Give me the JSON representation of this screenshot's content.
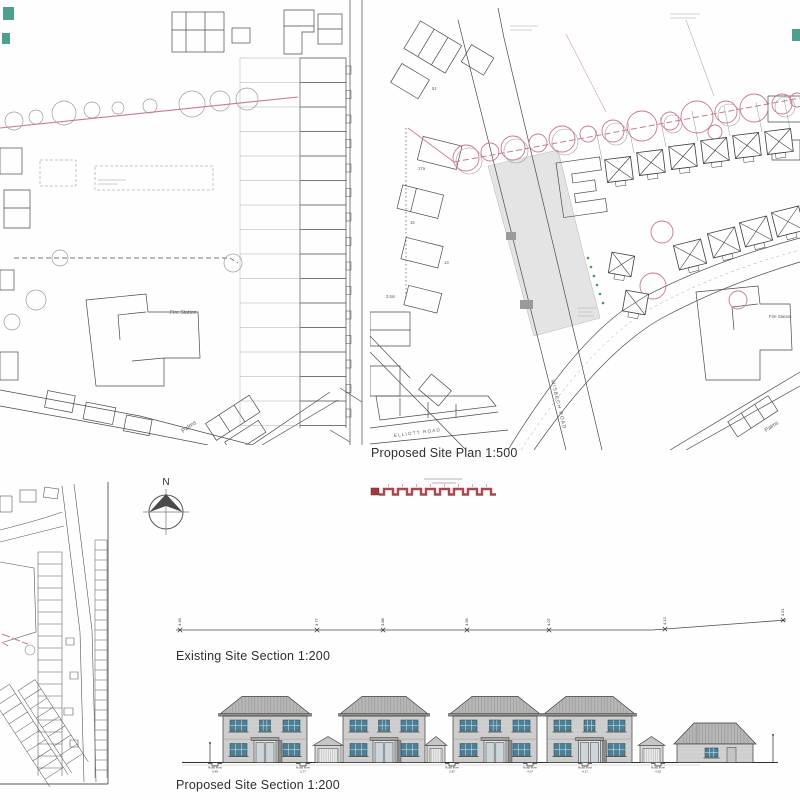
{
  "captions": {
    "proposed_site_plan": "Proposed Site Plan 1:500",
    "existing_site_section": "Existing Site Section 1:200",
    "proposed_site_section": "Proposed Site Section 1:200"
  },
  "labels": {
    "north": "N",
    "fire_station": "Fire Station",
    "wisbech_road": "WISBECH ROAD",
    "elliott_road": "ELLIOTT ROAD",
    "palms": "Palms",
    "plot_numbers": {
      "n51": "51",
      "n17a": "17a",
      "n15": "15",
      "n13": "13"
    },
    "dimension": "3.5m"
  },
  "existing_section": {
    "levels": [
      {
        "x": 8,
        "value": "3.49"
      },
      {
        "x": 145,
        "value": "3.77"
      },
      {
        "x": 211,
        "value": "3.88"
      },
      {
        "x": 295,
        "value": "3.95"
      },
      {
        "x": 377,
        "value": "4.07"
      },
      {
        "x": 493,
        "value": "4.12"
      },
      {
        "x": 611,
        "value": "4.21"
      }
    ]
  },
  "proposed_section": {
    "houses": [
      {
        "x": 43,
        "w": 84
      },
      {
        "x": 163,
        "w": 82
      },
      {
        "x": 273,
        "w": 84
      },
      {
        "x": 367,
        "w": 85
      }
    ],
    "garages": [
      {
        "x": 135,
        "w": 26
      },
      {
        "x": 247,
        "w": 18
      },
      {
        "x": 460,
        "w": 23
      }
    ],
    "bungalow": {
      "x": 497,
      "w": 76
    },
    "road_levels": [
      {
        "x": 35,
        "label": "Road level",
        "value": "3.49"
      },
      {
        "x": 123,
        "label": "Road level",
        "value": "3.77"
      },
      {
        "x": 272,
        "label": "Road level",
        "value": "3.87"
      },
      {
        "x": 350,
        "label": "Road level",
        "value": "4.07"
      },
      {
        "x": 405,
        "label": "Road level",
        "value": "4.17"
      },
      {
        "x": 478,
        "label": "Road level",
        "value": "4.35"
      }
    ]
  },
  "colors": {
    "ink": "#3d3d3d",
    "tree_pink": "#c9798c",
    "fence_red": "#a03a42",
    "house_wall": "#cfcfcf",
    "house_roof": "#b6b6b6",
    "window_teal": "#4c8096",
    "landscape_green": "#3f9e5f"
  }
}
